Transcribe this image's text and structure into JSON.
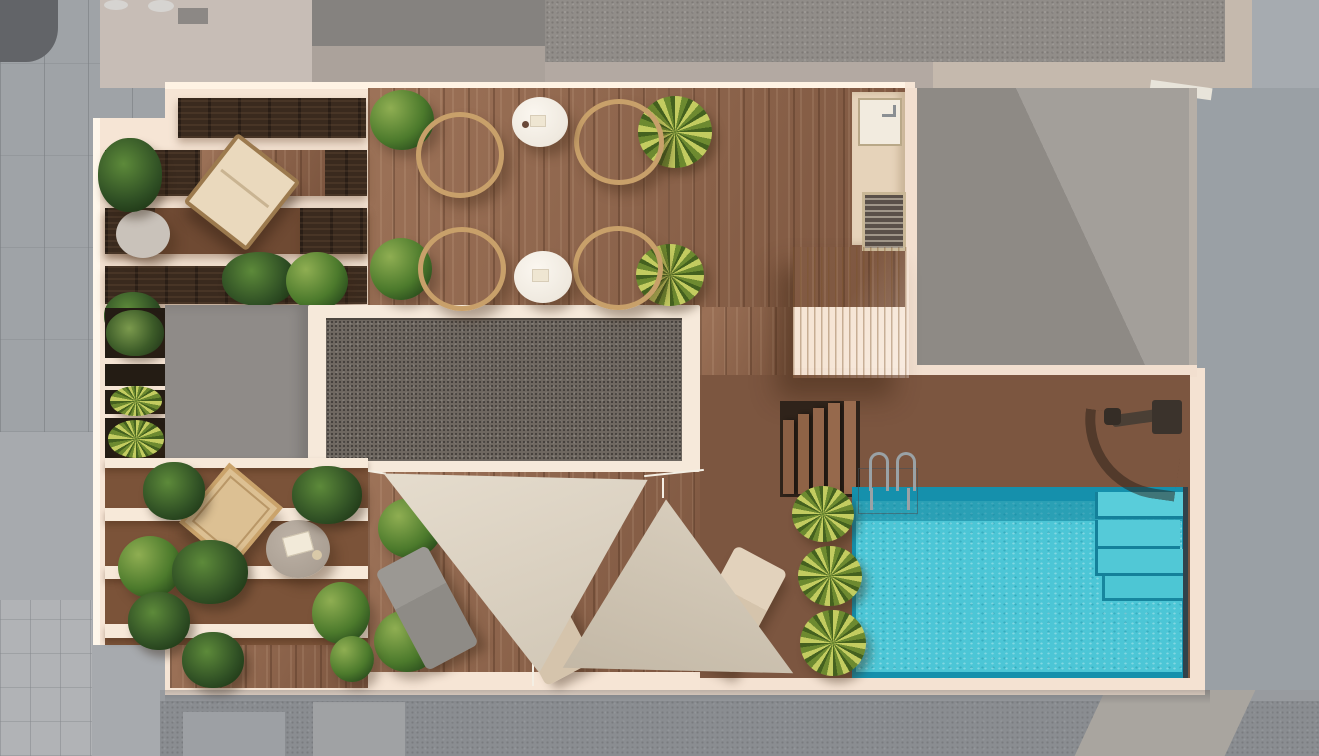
{
  "scene": {
    "type": "architectural-render",
    "view": "top-down-aerial",
    "description": "3D rendered top view of a rooftop terrace with wooden decking, louvred pergolas, a gravel skylight roof, outdoor kitchen counter, timber pergola deck, steps down to a pool deck, turquoise swimming pool with inner steps and ladder, outdoor shower, two triangular shade sails, three sun loungers, four round wicker chairs with two side tables, and many planters, surrounded by grey neighbouring roofs and pavement"
  },
  "palette": {
    "wall_cream": "#f6e5d5",
    "wall_glow": "#fff4e6",
    "deck_wood": "#8a5f46",
    "deck_wood_dark": "#7c5640",
    "espresso_slat": "#3a2a1e",
    "light_pergola": "#ecd0a0",
    "gravel_roof": "#6f6861",
    "flat_grey_roof": "#8f8b88",
    "neighbor_roof_grey": "#97938e",
    "pool_water": "#4cc6d6",
    "pool_rim": "#1590ac",
    "sail_beige": "#dbd1c1",
    "sail_taupe": "#cec3b1",
    "lounger_grey": "#94918c",
    "lounger_beige": "#dccbb4",
    "cushion_cream": "#ecdfc8",
    "plant_green": "#4c7a2c",
    "yucca_green": "#8aa63c",
    "pavement_grey": "#9fa3a7",
    "street_grey": "#8a8d91",
    "counter_beige": "#e6d3ba"
  },
  "objects": {
    "round_wicker_chairs": 4,
    "white_side_tables": 2,
    "lounge_chair_upper_left": 1,
    "small_round_tables": 2,
    "sun_loungers": 3,
    "shade_sails": 2,
    "swimming_pool": 1,
    "pool_inner_steps": 4,
    "pool_ladder": 1,
    "outdoor_shower": 1,
    "stair_treads": 5,
    "planters_and_plants": 20
  },
  "regions": [
    {
      "name": "upper-left-louvre-pergola",
      "material": "espresso wood louvres over cream beams"
    },
    {
      "name": "left-planter-column",
      "material": "dark planter boxes with plants"
    },
    {
      "name": "flat-grey-roof-block",
      "material": "plain grey membrane"
    },
    {
      "name": "gravel-skylight-roof",
      "material": "dark speckled gravel with cream frame"
    },
    {
      "name": "main-wood-deck",
      "material": "warm brown vertical planks"
    },
    {
      "name": "outdoor-kitchen-counter",
      "material": "beige counter with sink and grill"
    },
    {
      "name": "timber-pergola-deck",
      "material": "light timber slats"
    },
    {
      "name": "pool-deck",
      "material": "warm brown planks with steps"
    },
    {
      "name": "sail-shaded-deck",
      "material": "planks with loungers"
    },
    {
      "name": "lower-left-pergola-garden",
      "material": "beams, plants, parasol, table"
    },
    {
      "name": "neighbouring-roofs-and-streets",
      "material": "desaturated grey surroundings"
    }
  ]
}
